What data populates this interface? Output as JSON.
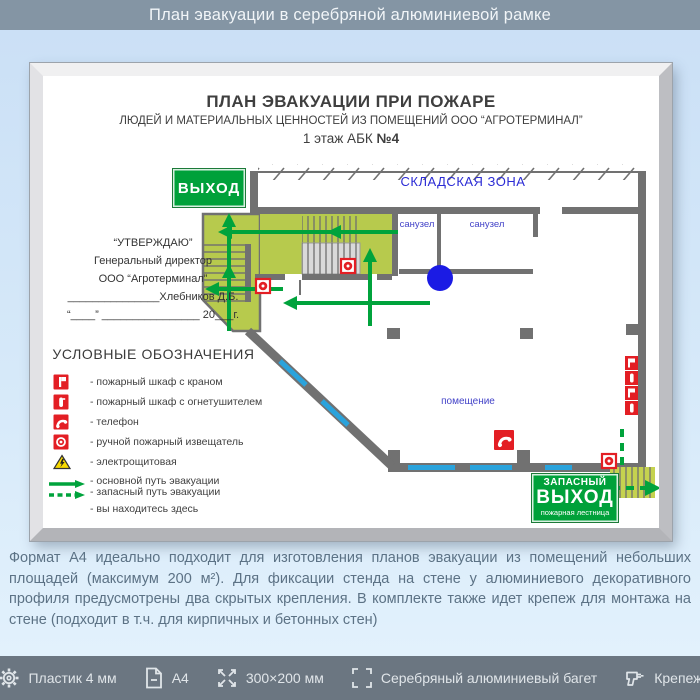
{
  "header": {
    "title": "План эвакуации в серебряной алюминиевой рамке"
  },
  "poster": {
    "title": "ПЛАН ЭВАКУАЦИИ ПРИ ПОЖАРЕ",
    "subtitle": "ЛЮДЕЙ И МАТЕРИАЛЬНЫХ ЦЕННОСТЕЙ ИЗ ПОМЕЩЕНИЙ ООО “АГРОТЕРМИНАЛ”",
    "floor_prefix": "1 этаж АБК ",
    "floor_bold": "№4",
    "approval": {
      "line1": "“УТВЕРЖДАЮ”",
      "line2": "Генеральный директор",
      "line3": "ООО “Агротерминал”",
      "line4": "_______________Хлебников Д.Б.",
      "line5": "“____” ________________ 20___г."
    },
    "labels": {
      "warehouse": "СКЛАДСКАЯ ЗОНА",
      "wc1": "санузел",
      "wc2": "санузел",
      "room": "помещение"
    },
    "exit_sign": "ВЫХОД",
    "emergency_sign": {
      "line1": "ЗАПАСНЫЙ",
      "line2": "ВЫХОД",
      "line3": "пожарная лестница"
    },
    "legend": {
      "heading": "УСЛОВНЫЕ ОБОЗНАЧЕНИЯ",
      "items": [
        {
          "icon": "fire-cabinet-hose-icon",
          "label": "- пожарный шкаф с краном"
        },
        {
          "icon": "fire-cabinet-extinguisher-icon",
          "label": "- пожарный шкаф с огнетушителем"
        },
        {
          "icon": "phone-icon",
          "label": "- телефон"
        },
        {
          "icon": "manual-call-point-icon",
          "label": "- ручной пожарный извещатель"
        },
        {
          "icon": "electrical-hazard-icon",
          "label": "- электрощитовая"
        },
        {
          "icon": "main-route-arrow-icon",
          "label": "- основной путь эвакуации"
        },
        {
          "icon": "secondary-route-arrow-icon",
          "label": "- запасный путь эвакуации"
        },
        {
          "icon": "you-are-here-icon",
          "label": "- вы находитесь здесь"
        }
      ]
    }
  },
  "description": "Формат А4 идеально подходит для изготовления планов эвакуации из помещений небольших площадей (максимум 200 м²). Для фиксации стенда на стене у алюминиевого декоративного профиля предусмотрены два скрытых крепления. В комплекте также идет крепеж для монтажа на стене (подходит в т.ч. для кирпичных и бетонных стен)",
  "specs": [
    {
      "icon": "gear-icon",
      "label": "Пластик 4 мм"
    },
    {
      "icon": "document-icon",
      "label": "А4"
    },
    {
      "icon": "dimensions-icon",
      "label": "300×200 мм"
    },
    {
      "icon": "frame-icon",
      "label": "Серебряный алюминиевый багет"
    },
    {
      "icon": "fastener-icon",
      "label": "Крепеж"
    }
  ],
  "colors": {
    "top_bar": "#8495a4",
    "bottom_bar": "#6b7681",
    "background": "#d6e9f9",
    "sign_green": "#00a13a",
    "route_green": "#00a33c",
    "plan_area_green": "#b7ca4d",
    "alarm_red": "#e31e24",
    "label_blue": "#2b2bd5",
    "wall_gray": "#717171",
    "window_blue": "#2aa3dc",
    "you_are_here_blue": "#1b1be4",
    "frame_silver": "#d9d9dc"
  }
}
